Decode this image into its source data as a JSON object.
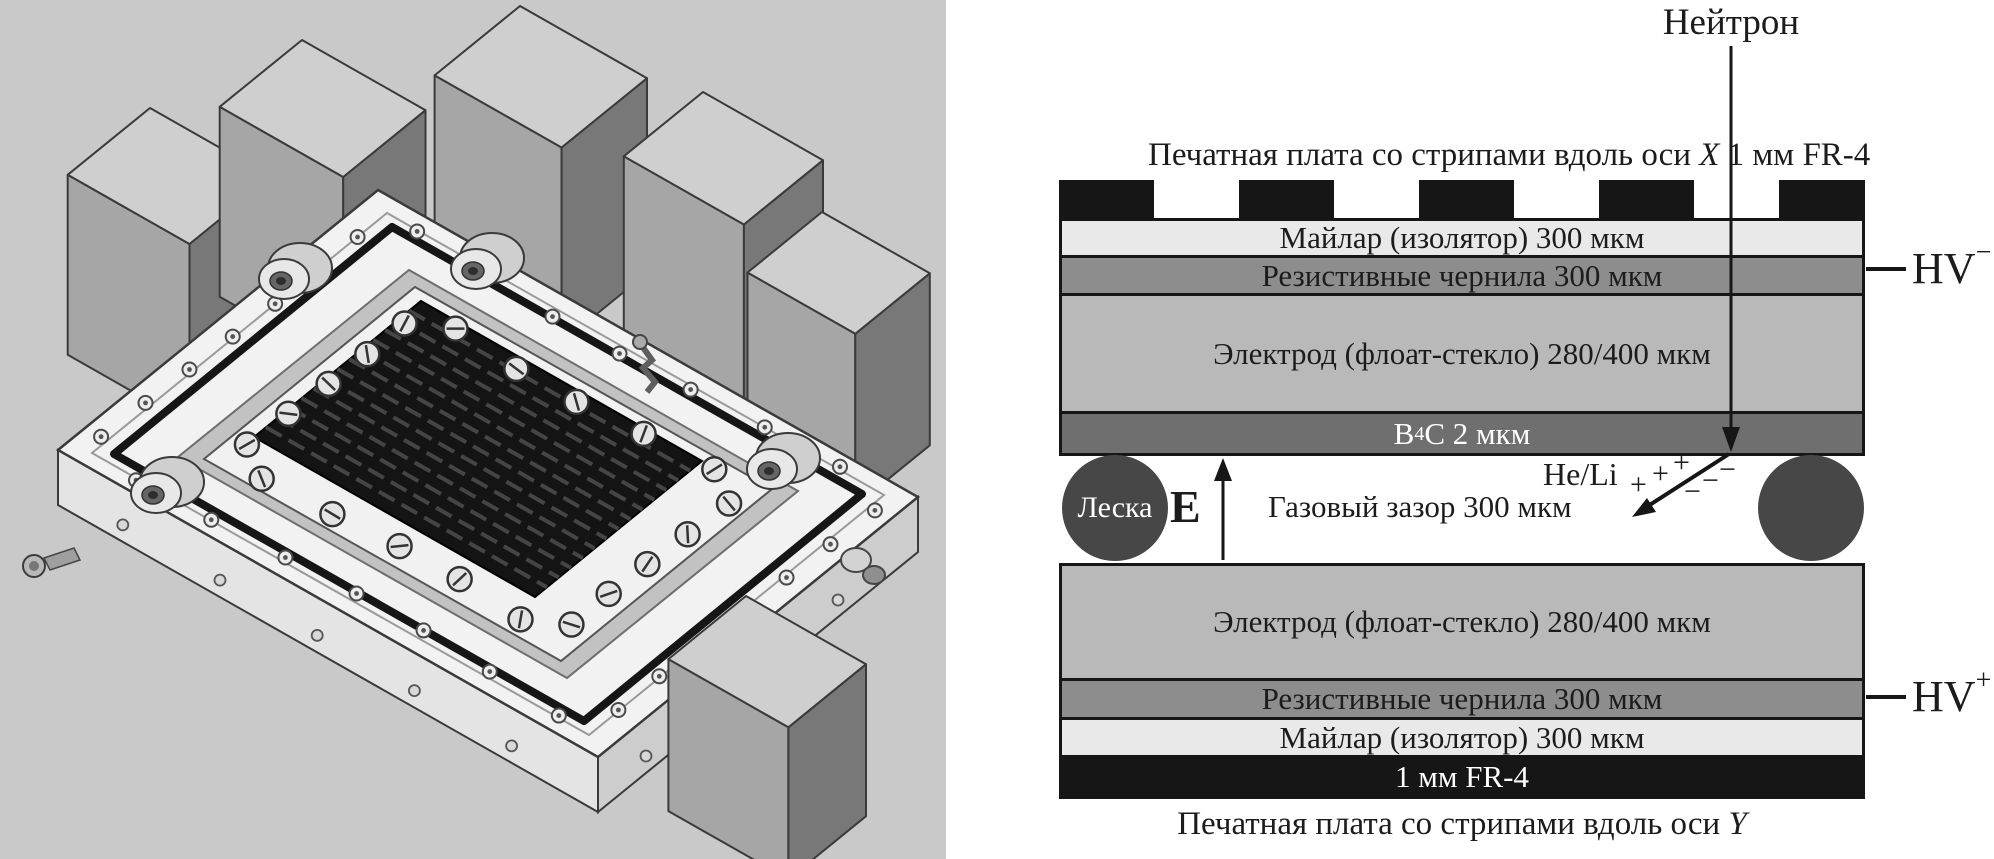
{
  "diagram": {
    "neutron_label": "Нейтрон",
    "top_caption": {
      "text": "Печатная плата со стрипами вдоль оси ",
      "axis": "X",
      "suffix": " 1 мм FR-4"
    },
    "bottom_caption": {
      "text": "Печатная плата со стрипами вдоль оси ",
      "axis": "Y"
    },
    "layers": {
      "mylar_top": "Майлар (изолятор) 300 мкм",
      "ink_top": "Резистивные чернила 300 мкм",
      "electrode_top": "Электрод (флоат-стекло) 280/400 мкм",
      "b4c": {
        "el1": "B",
        "sub": "4",
        "el2": "C 2 мкм"
      },
      "electrode_bottom": "Электрод (флоат-стекло) 280/400 мкм",
      "ink_bottom": "Резистивные чернила 300 мкм",
      "mylar_bottom": "Майлар (изолятор) 300 мкм",
      "fr4": "1 мм FR-4"
    },
    "gas_gap": {
      "spacer_label": "Леска",
      "field_label": "E",
      "gap_label": "Газовый зазор 300 мкм",
      "ion_label": "He/Li",
      "plus_sign": "+",
      "minus_sign": "−"
    },
    "hv_top": {
      "text": "HV",
      "sign": "−"
    },
    "hv_bottom": {
      "text": "HV",
      "sign": "+"
    },
    "colors": {
      "render_background": "#c9c9c9",
      "mylar": "#e9e9e9",
      "resistive_ink": "#8d8d8d",
      "electrode_glass": "#b9b9b9",
      "b4c_coating": "#6f6f6f",
      "spacer": "#474747",
      "pcb_black": "#161616"
    }
  }
}
